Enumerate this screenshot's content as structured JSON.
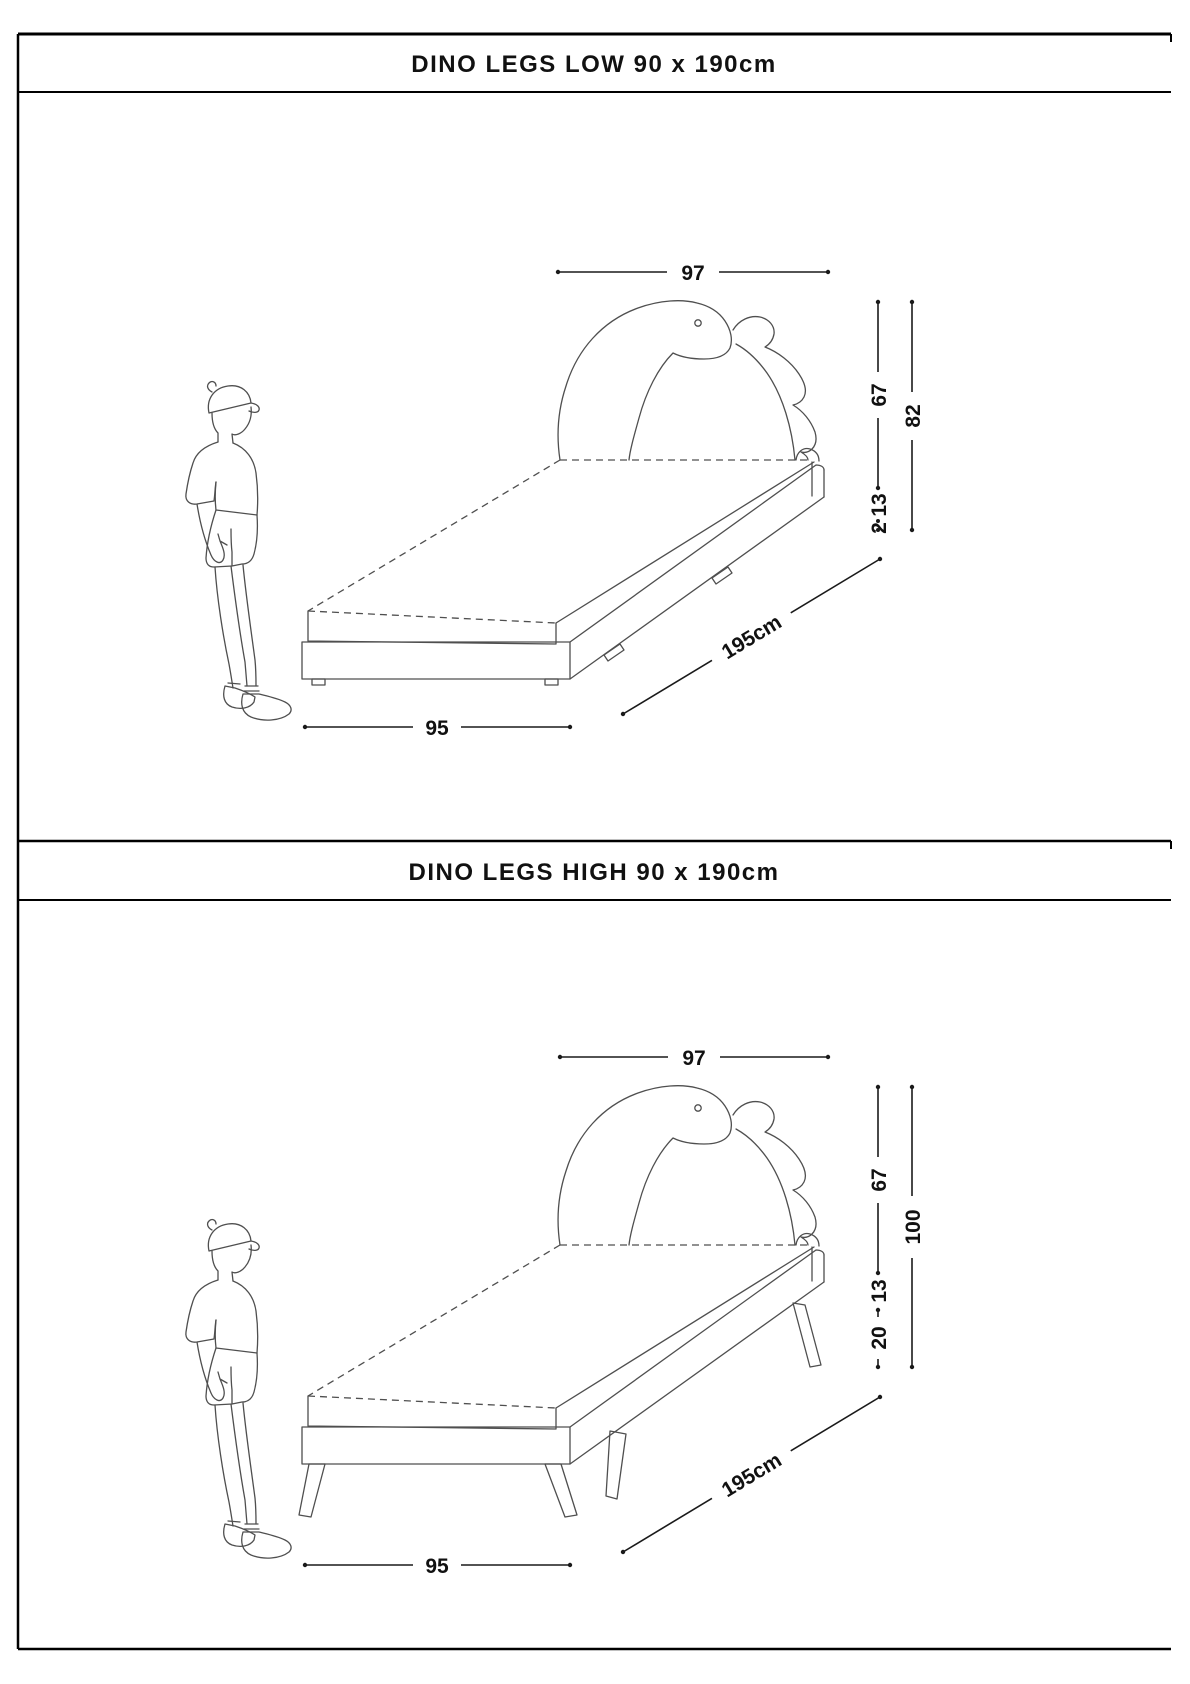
{
  "page": {
    "background": "#ffffff",
    "border_color": "#000000",
    "drawing_line_color": "#4f4f4f",
    "dimension_color": "#1a1a1a"
  },
  "panels": [
    {
      "title": "DINO LEGS LOW 90 x 190cm",
      "dimensions": {
        "headboard_width": "97",
        "headboard_height": "67",
        "total_height": "82",
        "frame_height": "13",
        "leg_height": "2",
        "bed_length": "195cm",
        "bed_width": "95"
      }
    },
    {
      "title": "DINO LEGS HIGH 90 x 190cm",
      "dimensions": {
        "headboard_width": "97",
        "headboard_height": "67",
        "total_height": "100",
        "frame_height": "13",
        "leg_height": "20",
        "bed_length": "195cm",
        "bed_width": "95"
      }
    }
  ]
}
